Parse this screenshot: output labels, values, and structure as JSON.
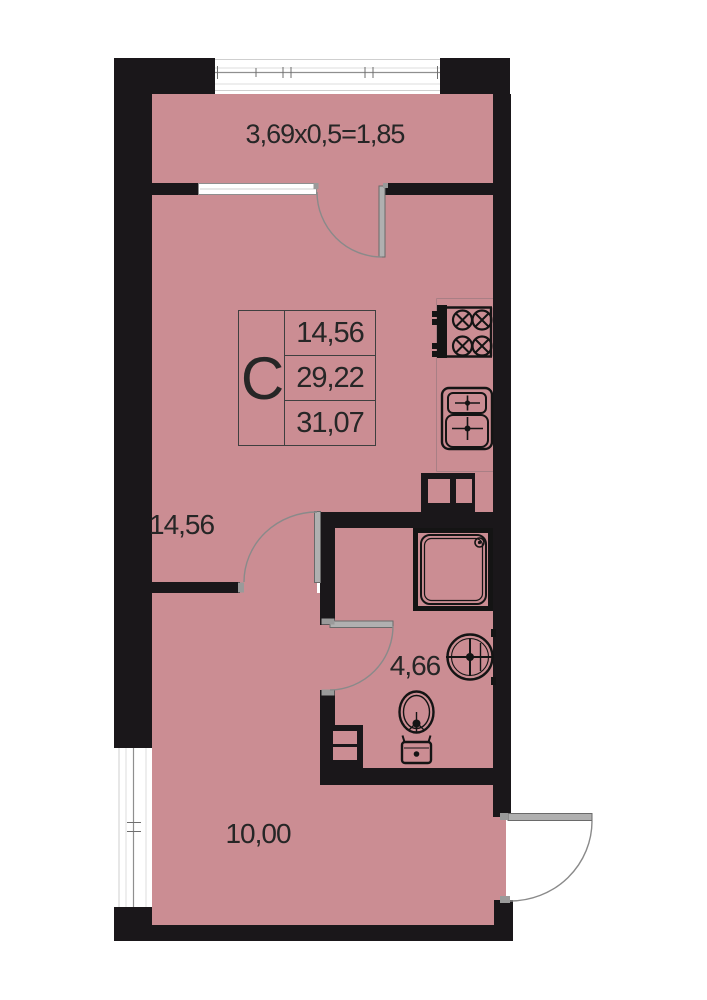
{
  "plan_title": "Studio apartment floor plan",
  "stamp": {
    "type_label": "C",
    "rows": [
      "14,56",
      "29,22",
      "31,07"
    ]
  },
  "labels": {
    "balcony_dim": "3,69x0,5=1,85",
    "living_area": "14,56",
    "bathroom_area": "4,66",
    "hall_area": "10,00"
  },
  "fixtures": [
    "stove-icon",
    "kitchen-sink-icon",
    "shower-icon",
    "washbasin-icon",
    "toilet-icon",
    "vent-shaft",
    "duct-shaft"
  ],
  "colors": {
    "floor": "#cb8d93",
    "wall": "#1a171a",
    "door_leaf": "#b0b0b0",
    "arc_line": "#8a8a8a",
    "window_frame": "#8f8f8f",
    "text": "#262626"
  }
}
